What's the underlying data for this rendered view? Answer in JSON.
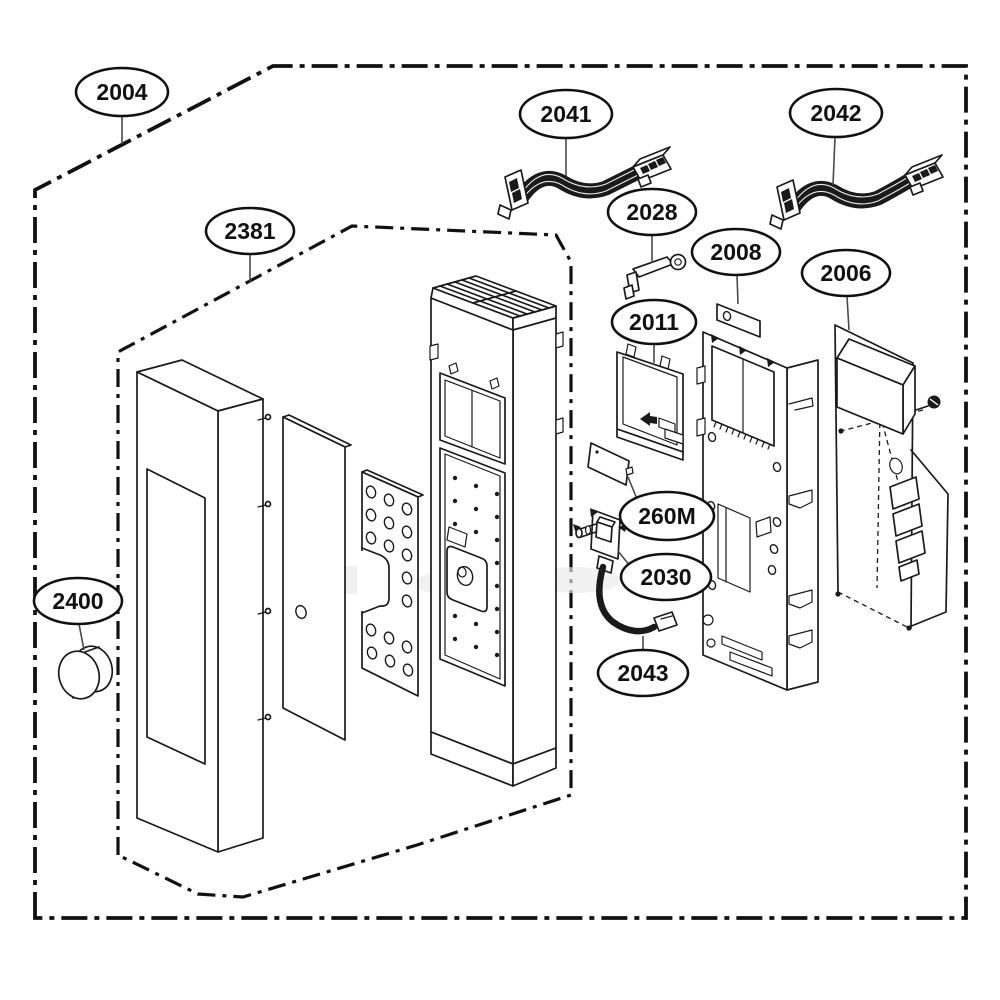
{
  "colors": {
    "background": "#ffffff",
    "line": "#1a1a1a",
    "callout_stroke": "#111111"
  },
  "callouts": [
    {
      "label": "2004"
    },
    {
      "label": "2381"
    },
    {
      "label": "2041"
    },
    {
      "label": "2042"
    },
    {
      "label": "2028"
    },
    {
      "label": "2008"
    },
    {
      "label": "2006"
    },
    {
      "label": "2011"
    },
    {
      "label": "260M"
    },
    {
      "label": "2030"
    },
    {
      "label": "2043"
    },
    {
      "label": "2400"
    }
  ]
}
